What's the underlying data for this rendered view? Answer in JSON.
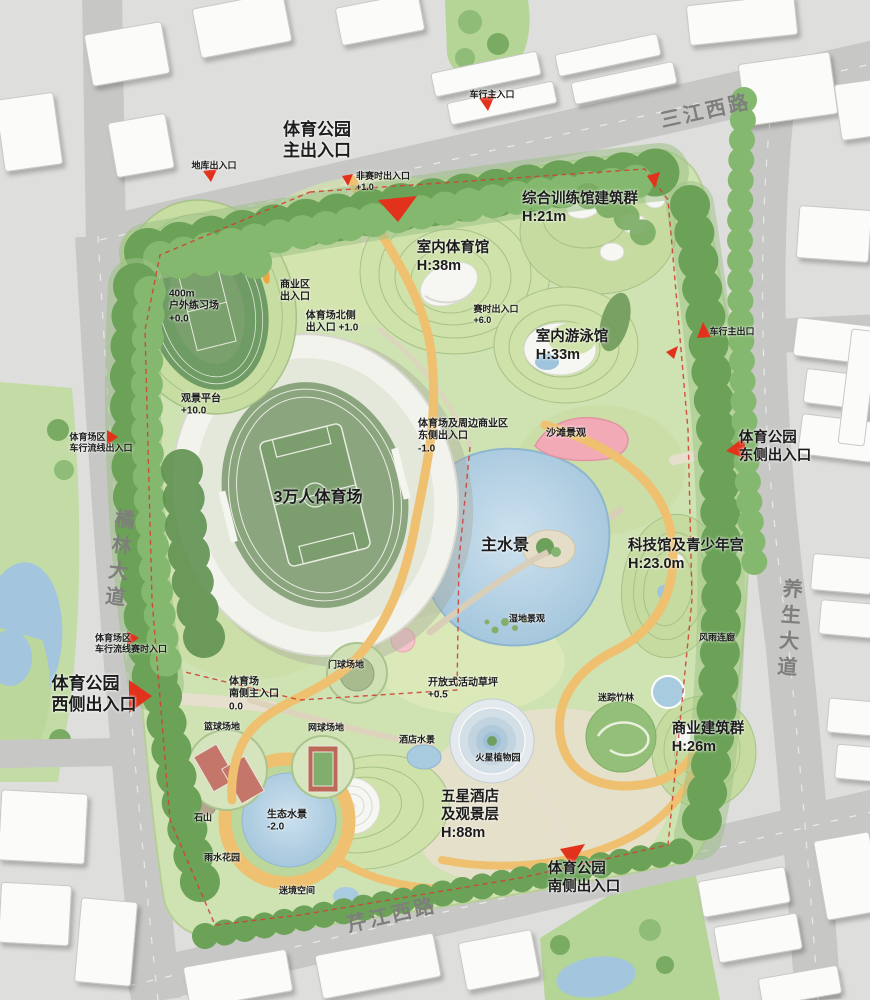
{
  "map": {
    "roads": {
      "north": "三江西路",
      "west": "橘林大道",
      "east": "养生大道",
      "south": "芹江西路"
    },
    "labels": {
      "main_entrance": "体育公园\n主出入口",
      "vehicle_main_entrance": "车行主入口",
      "garage_entrance": "地库出入口",
      "non_event_entrance": "非赛时出入口\n+1.0",
      "training_complex": "综合训练馆建筑群\nH:21m",
      "indoor_gym": "室内体育馆\nH:38m",
      "practice_field": "400m\n户外练习场\n+0.0",
      "commercial_entrance": "商业区\n出入口",
      "stadium_north_entrance": "体育场北侧\n出入口 +1.0",
      "event_entrance": "赛时出入口\n+6.0",
      "indoor_pool": "室内游泳馆\nH:33m",
      "vehicle_main_exit": "车行主出口",
      "east_entrance": "体育公园\n东侧出入口",
      "viewing_platform": "观景平台\n+10.0",
      "stadium": "3万人体育场",
      "stadium_commercial_east_entrance": "体育场及周边商业区\n东侧出入口\n-1.0",
      "beach": "沙滩景观",
      "main_water": "主水景",
      "science_youth_center": "科技馆及青少年宫\nH:23.0m",
      "wetland": "湿地景观",
      "rain_corridor": "风雨连廊",
      "stadium_vehicle_entrance_north": "体育场区\n车行流线出入口",
      "west_entrance": "体育公园\n西侧出入口",
      "stadium_vehicle_entrance_south": "体育场区\n车行流线赛时入口",
      "stadium_south_entrance": "体育场\n南侧主入口\n0.0",
      "gateball_court": "门球场地",
      "tennis_court": "网球场地",
      "basketball_court": "篮球场地",
      "activity_lawn": "开放式活动草坪\n+0.5",
      "bamboo_maze": "迷踪竹林",
      "hotel_water": "酒店水景",
      "mars_garden": "火星植物园",
      "commercial_complex": "商业建筑群\nH:26m",
      "stone_hill": "石山",
      "eco_water": "生态水景\n-2.0",
      "rain_garden": "雨水花园",
      "mist_space": "迷境空间",
      "hotel": "五星酒店\n及观景层\nH:88m",
      "south_entrance": "体育公园\n南侧出入口"
    },
    "palette": {
      "arrow_red": "#e2321b",
      "boundary_red": "#cf4234",
      "water_blue": "#a9cbe0",
      "path_yellow": "#eec06f",
      "tree_green": "#6ba257",
      "lawn_green": "#cfe2b2",
      "beach_pink": "#f2aab6",
      "road_gray": "#c7c7c6",
      "building_white": "#fbfbfa"
    }
  }
}
